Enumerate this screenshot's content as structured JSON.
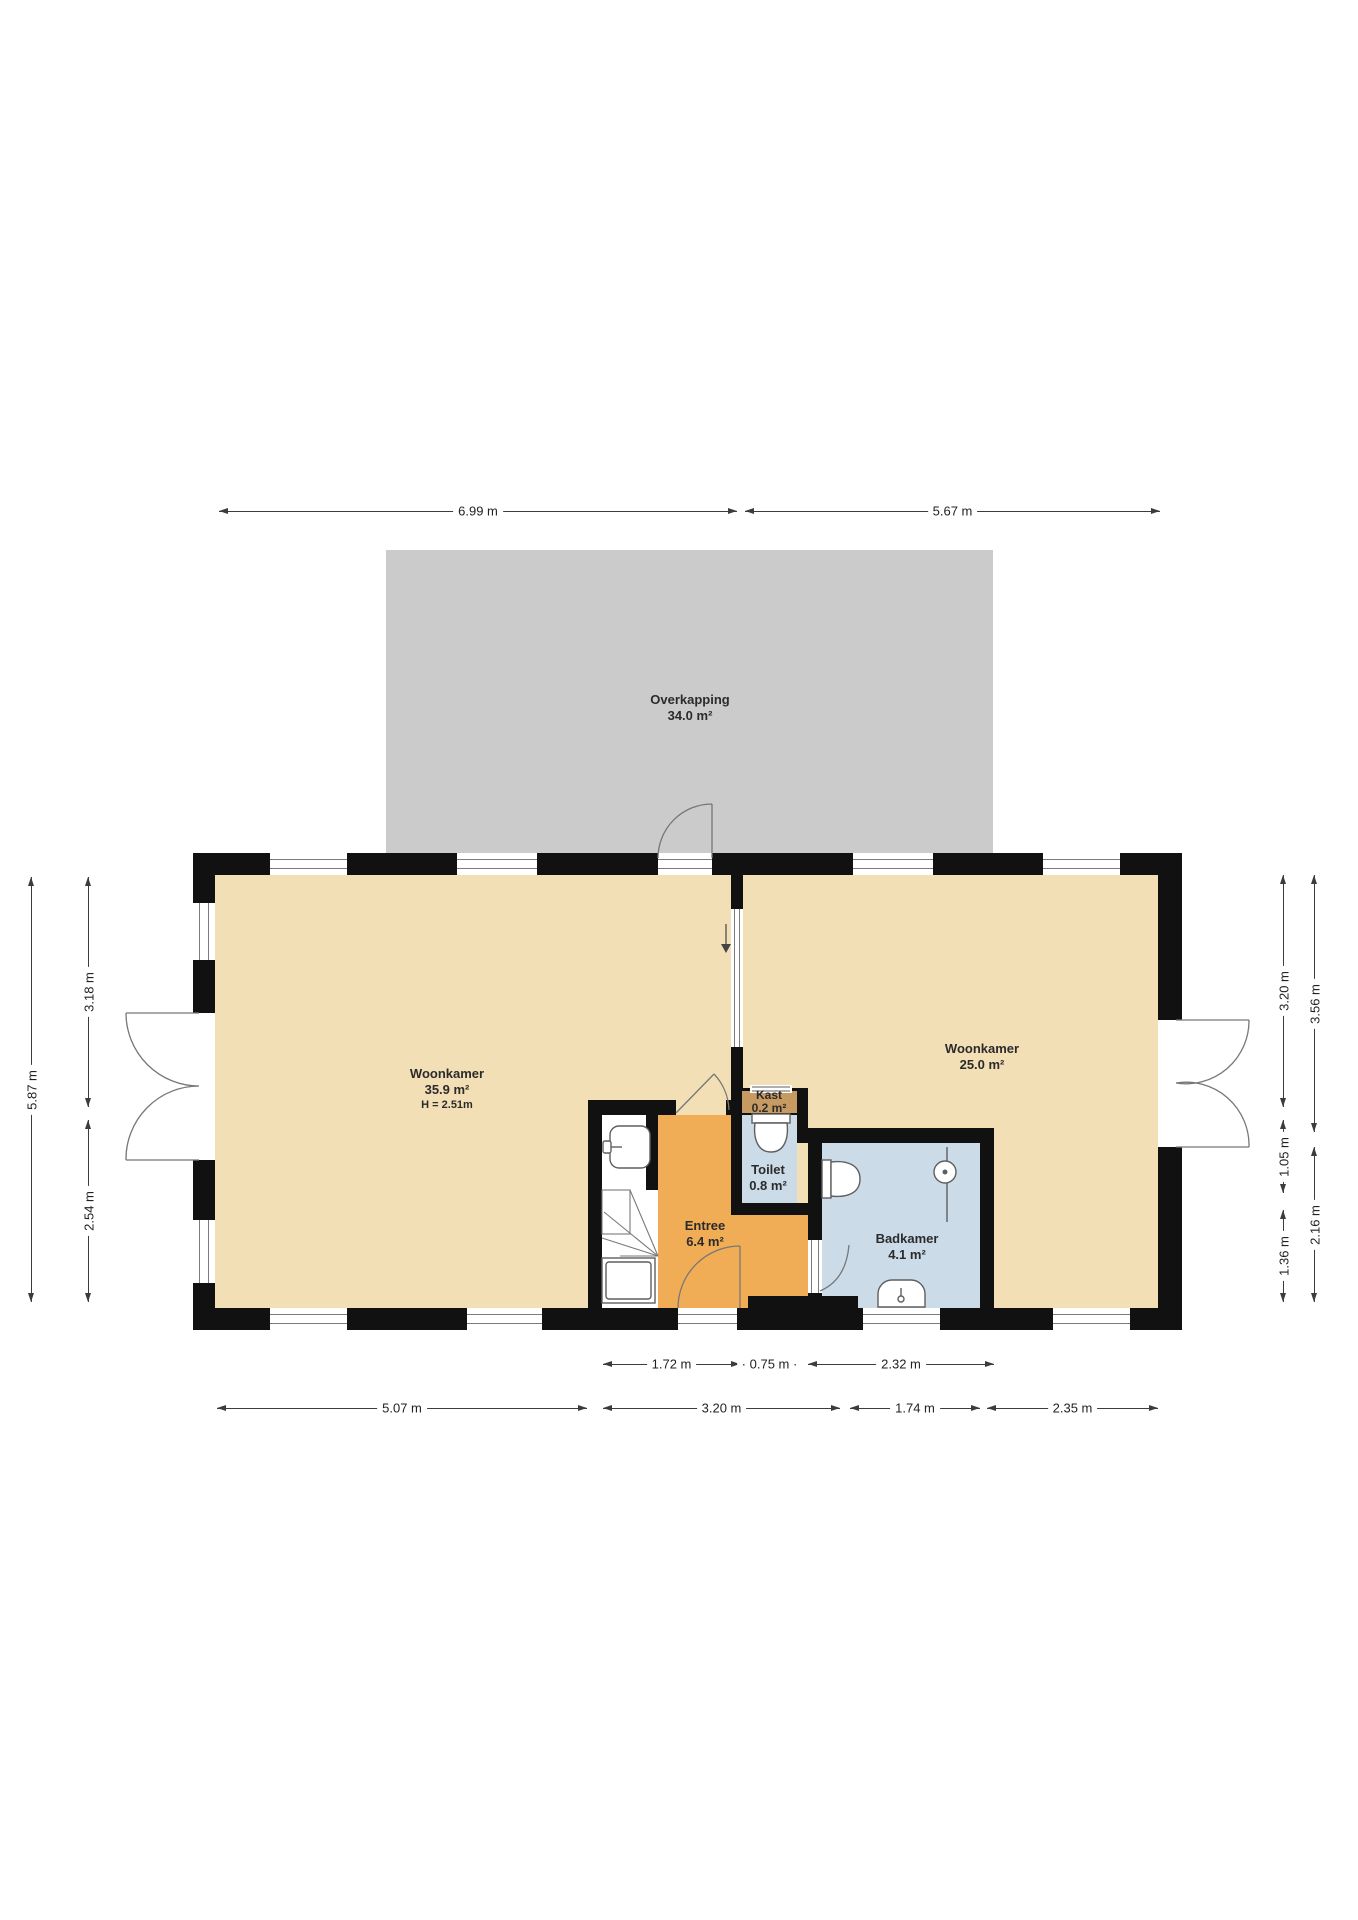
{
  "rooms": {
    "overkapping": {
      "name": "Overkapping",
      "area": "34.0 m²"
    },
    "woonkamer_left": {
      "name": "Woonkamer",
      "area": "35.9 m²",
      "ceiling_height": "H = 2.51m"
    },
    "woonkamer_right": {
      "name": "Woonkamer",
      "area": "25.0 m²"
    },
    "entree": {
      "name": "Entree",
      "area": "6.4 m²"
    },
    "toilet": {
      "name": "Toilet",
      "area": "0.8 m²"
    },
    "kast": {
      "name": "Kast",
      "area": "0.2 m²"
    },
    "badkamer": {
      "name": "Badkamer",
      "area": "4.1 m²"
    }
  },
  "dimensions": {
    "top": [
      {
        "label": "6.99 m"
      },
      {
        "label": "5.67 m"
      }
    ],
    "left": [
      {
        "label": "5.87 m"
      },
      {
        "label": "3.18 m"
      },
      {
        "label": "2.54 m"
      }
    ],
    "right": [
      {
        "label": "3.20 m"
      },
      {
        "label": "1.05 m"
      },
      {
        "label": "1.36 m"
      },
      {
        "label": "3.56 m"
      },
      {
        "label": "2.16 m"
      }
    ],
    "bottom_inner": [
      {
        "label": "1.72 m"
      },
      {
        "label": "0.75 m"
      },
      {
        "label": "2.32 m"
      }
    ],
    "bottom_outer": [
      {
        "label": "5.07 m"
      },
      {
        "label": "3.20 m"
      },
      {
        "label": "1.74 m"
      },
      {
        "label": "2.35 m"
      }
    ]
  },
  "colors": {
    "floor": "#F3DFB5",
    "entree": "#F1AD55",
    "wet": "#CBDCE8",
    "kast": "#C79A62",
    "overkapping": "#CBCBCB",
    "wall": "#111111"
  }
}
